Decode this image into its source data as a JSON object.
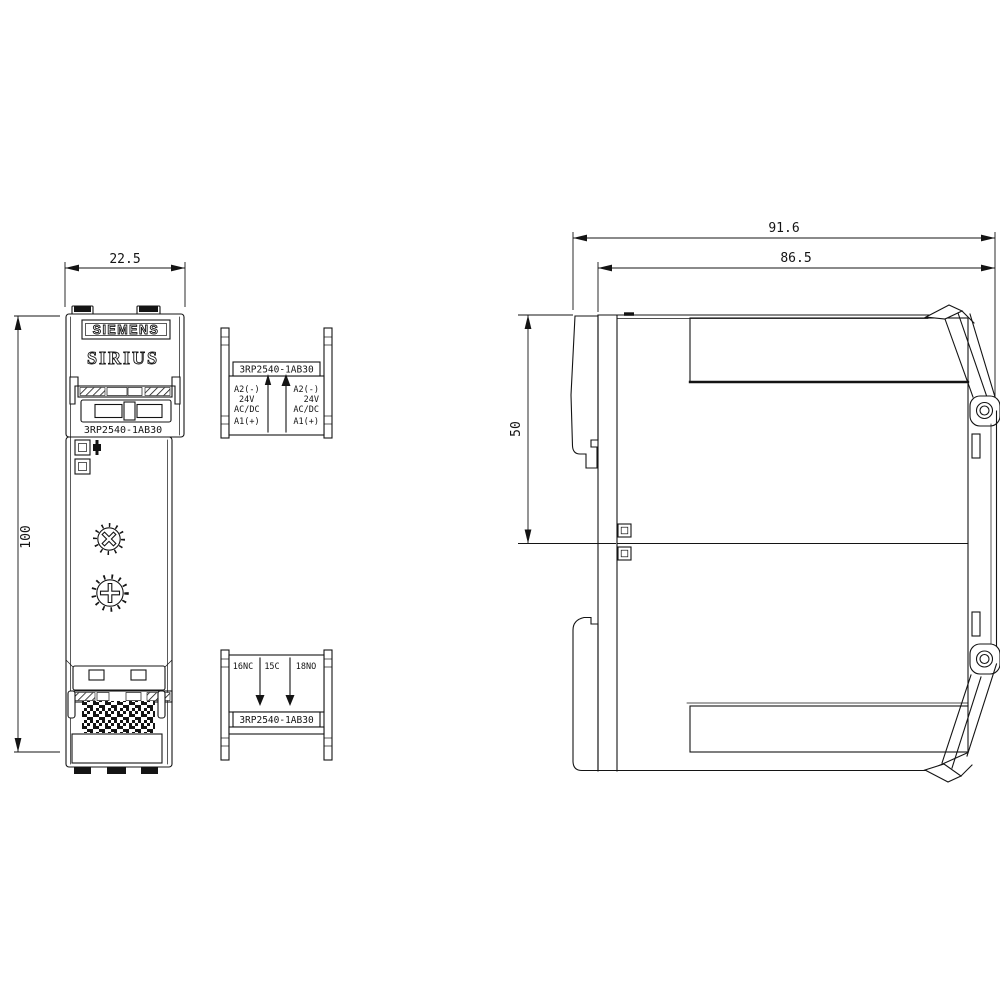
{
  "drawing": {
    "brand": "SIEMENS",
    "series": "SIRIUS",
    "product_code": "3RP2540-1AB30",
    "line_color": "#141414",
    "background": "#ffffff",
    "dims": {
      "front_width": "22.5",
      "front_height": "100",
      "depth_total": "91.6",
      "depth_body": "86.5",
      "upper_depth": "50"
    },
    "top_terminal_block": {
      "code": "3RP2540-1AB30",
      "left_column": [
        "A2(-)",
        "24V",
        "AC/DC",
        "A1(+)"
      ],
      "right_column": [
        "A2(-)",
        "24V",
        "AC/DC",
        "A1(+)"
      ]
    },
    "bottom_terminal_block": {
      "terminals": [
        "16NC",
        "15C",
        "18NO"
      ],
      "code": "3RP2540-1AB30"
    }
  }
}
